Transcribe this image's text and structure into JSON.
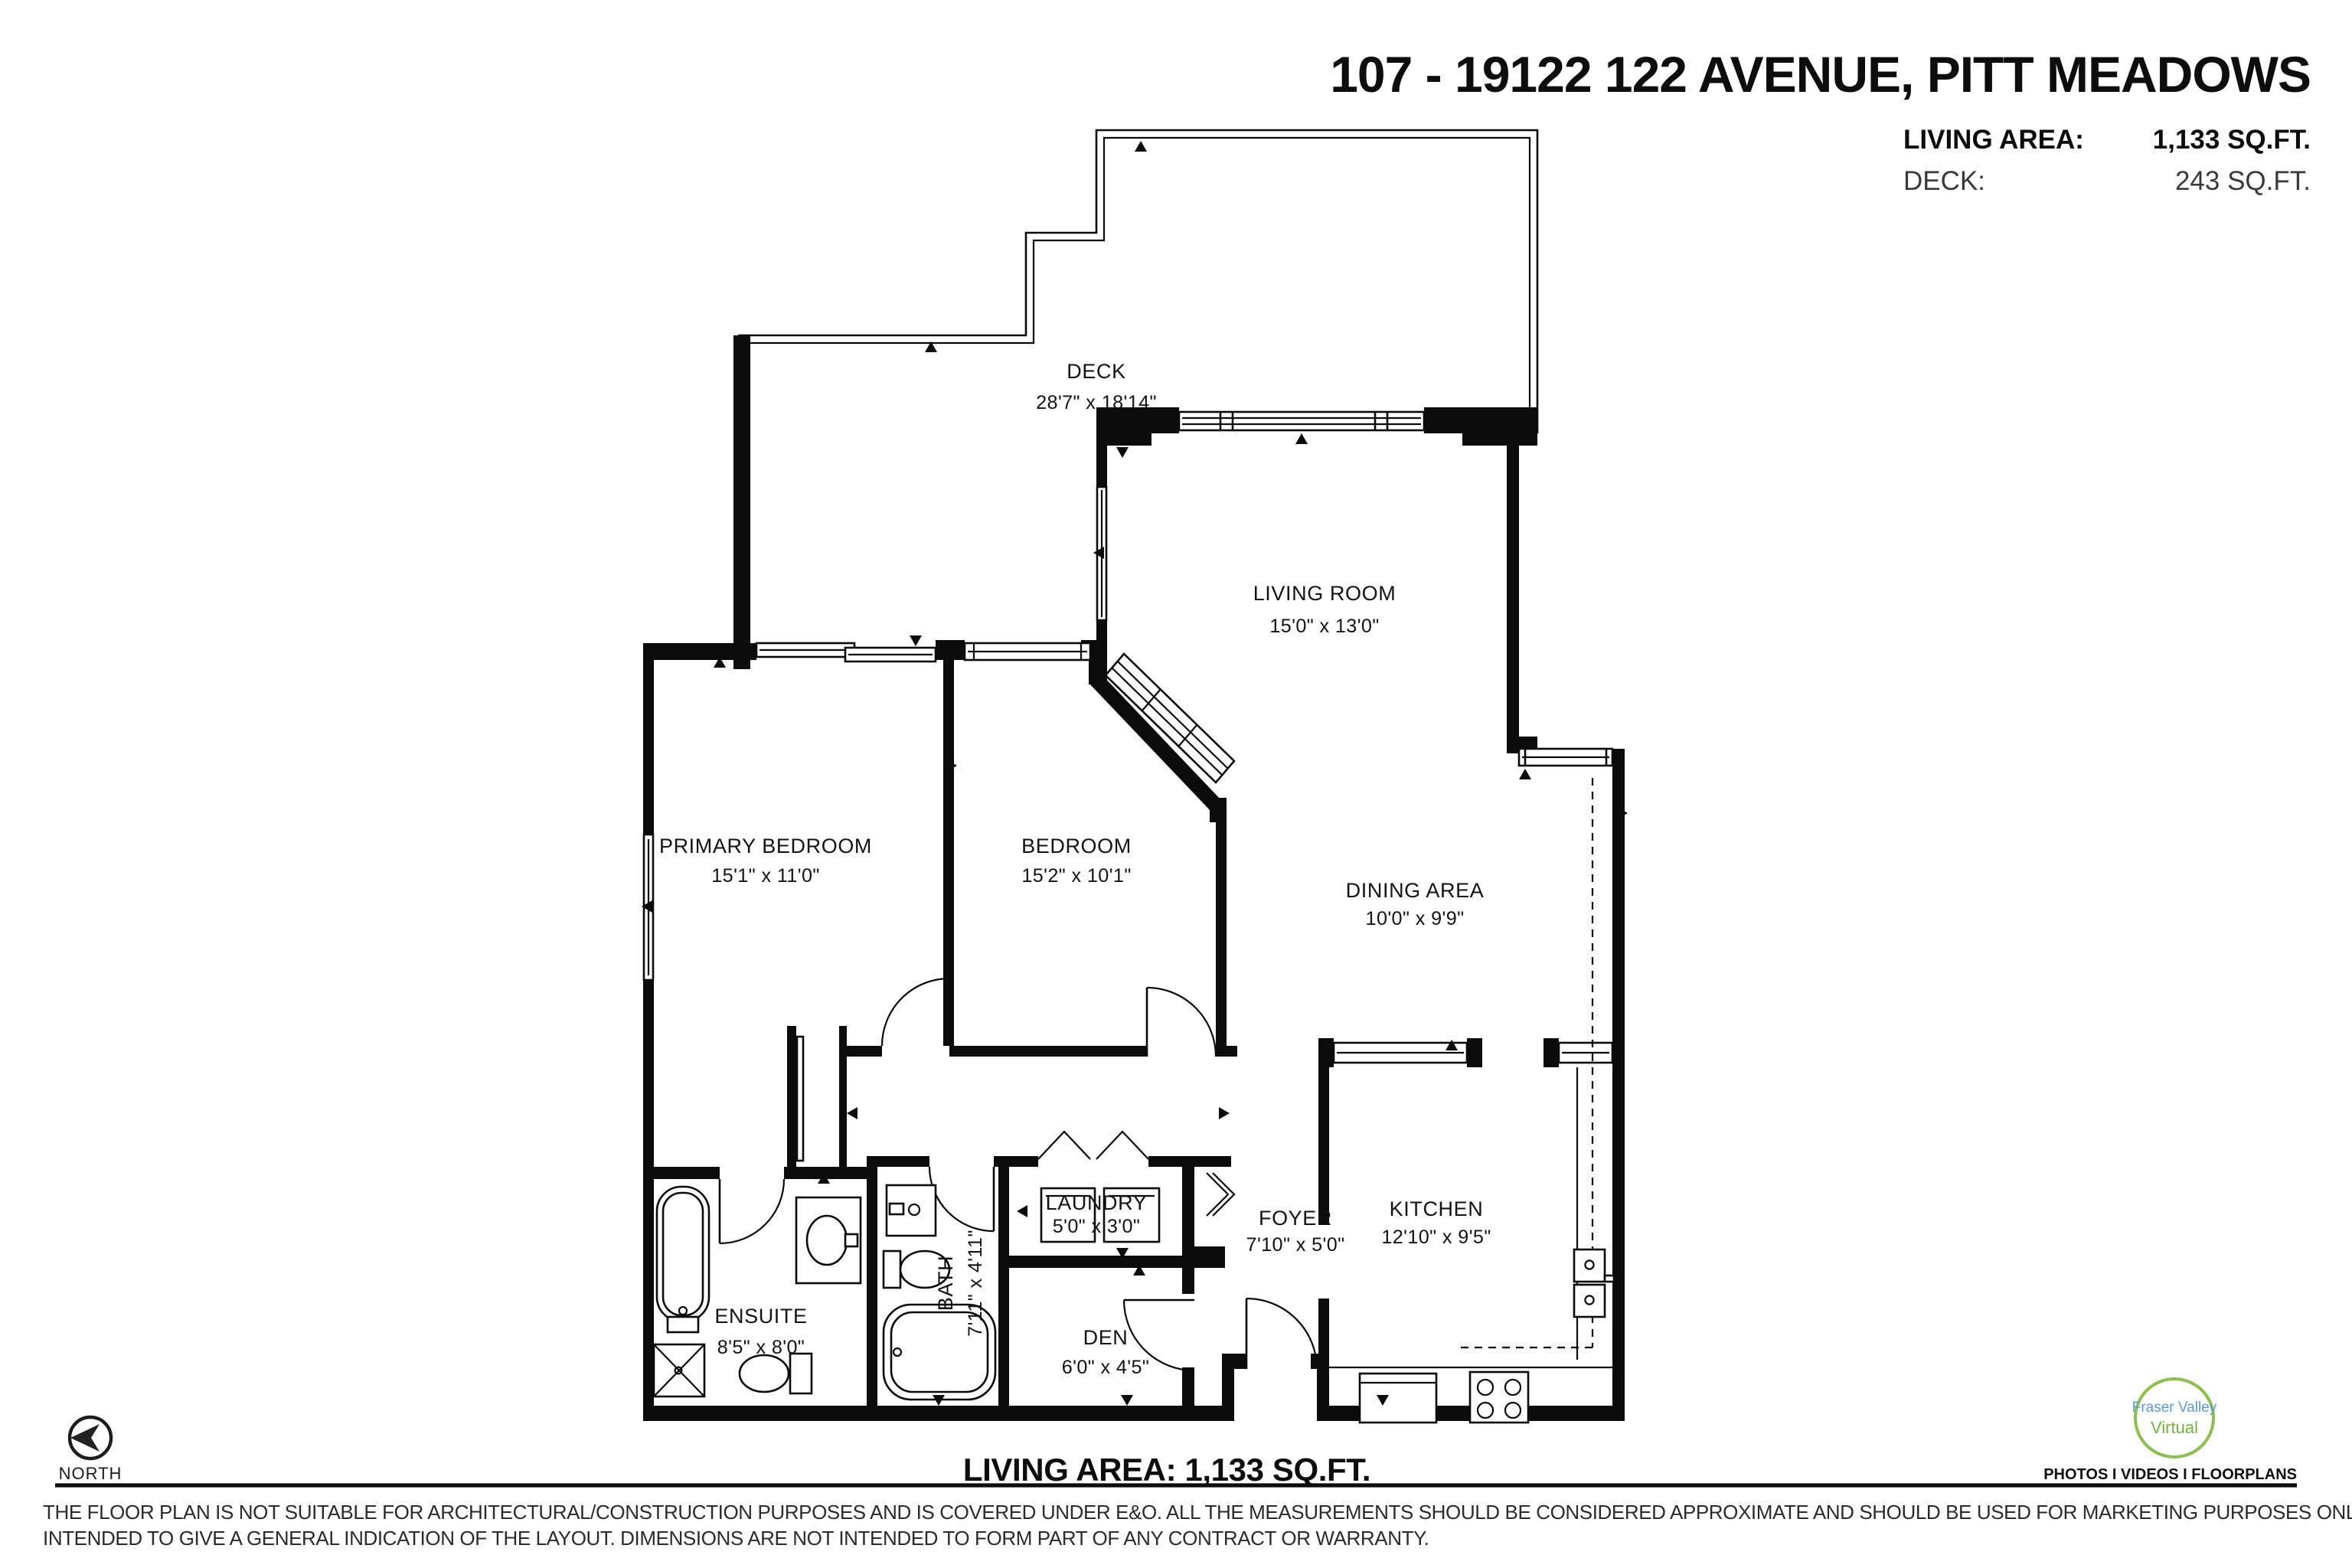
{
  "header": {
    "title": "107 - 19122 122 AVENUE, PITT MEADOWS",
    "living_area_label": "LIVING AREA:",
    "living_area_value": "1,133 SQ.FT.",
    "deck_label": "DECK:",
    "deck_value": "243 SQ.FT."
  },
  "rooms": [
    {
      "name": "DECK",
      "dims": "28'7\" x 18'14\""
    },
    {
      "name": "LIVING ROOM",
      "dims": "15'0\" x 13'0\""
    },
    {
      "name": "PRIMARY BEDROOM",
      "dims": "15'1\" x 11'0\""
    },
    {
      "name": "BEDROOM",
      "dims": "15'2\" x 10'1\""
    },
    {
      "name": "DINING AREA",
      "dims": "10'0\" x 9'9\""
    },
    {
      "name": "KITCHEN",
      "dims": "12'10\" x 9'5\""
    },
    {
      "name": "FOYER",
      "dims": "7'10\" x 5'0\""
    },
    {
      "name": "LAUNDRY",
      "dims": "5'0\" x 3'0\""
    },
    {
      "name": "DEN",
      "dims": "6'0\" x 4'5\""
    },
    {
      "name": "BATH",
      "dims": "7'11\" x 4'11\""
    },
    {
      "name": "ENSUITE",
      "dims": "8'5\" x 8'0\""
    }
  ],
  "footer": {
    "north_label": "NORTH",
    "living_area_total": "LIVING AREA: 1,133 SQ.FT.",
    "logo_line1": "Fraser Valley",
    "logo_line2": "Virtual",
    "services": "PHOTOS I VIDEOS I FLOORPLANS",
    "disclaimer_line1": "THE FLOOR PLAN IS NOT SUITABLE FOR ARCHITECTURAL/CONSTRUCTION PURPOSES AND IS COVERED UNDER E&O. ALL THE MEASUREMENTS SHOULD BE CONSIDERED APPROXIMATE AND SHOULD BE USED FOR MARKETING PURPOSES ONLY. FLOOR PLAN(S) IS",
    "disclaimer_line2": "INTENDED TO GIVE A GENERAL INDICATION OF THE LAYOUT. DIMENSIONS ARE NOT INTENDED TO FORM PART OF ANY CONTRACT OR WARRANTY."
  },
  "colors": {
    "wall": "#0b0b0b",
    "logo_green": "#8CBF4D",
    "logo_blue": "#5B9BD5"
  }
}
